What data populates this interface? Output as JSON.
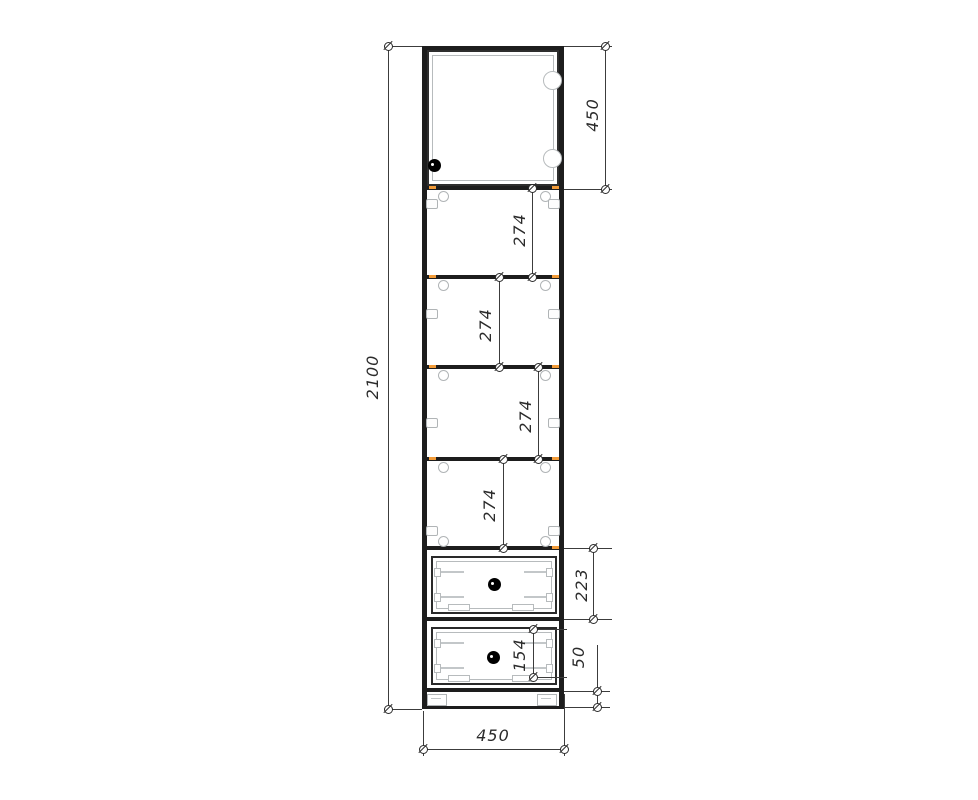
{
  "drawing": {
    "kind": "furniture-technical-drawing",
    "subject": "tall-cabinet-front-elevation",
    "dimensions": {
      "overall_height": "2100",
      "overall_width": "450",
      "top_door_section_height": "450",
      "shelf_gaps": [
        "274",
        "274",
        "274",
        "274"
      ],
      "drawer1_front_height": "223",
      "drawer2_inner_spacing": "154",
      "plinth_height": "50"
    },
    "colors": {
      "panel_line": "#1d1d1d",
      "dimension_line": "#3c3c3c",
      "hardware_detail": "#b7bbbd",
      "shelf_edge_accent": "#f29b38",
      "knob": "#000000"
    },
    "icons": {
      "dimension_terminator": "circle-with-slash",
      "door_knob": "filled-circle",
      "drawer_knob": "filled-circle",
      "hinge": "circle-outline",
      "adjustable_foot": "bracket-rect"
    }
  }
}
